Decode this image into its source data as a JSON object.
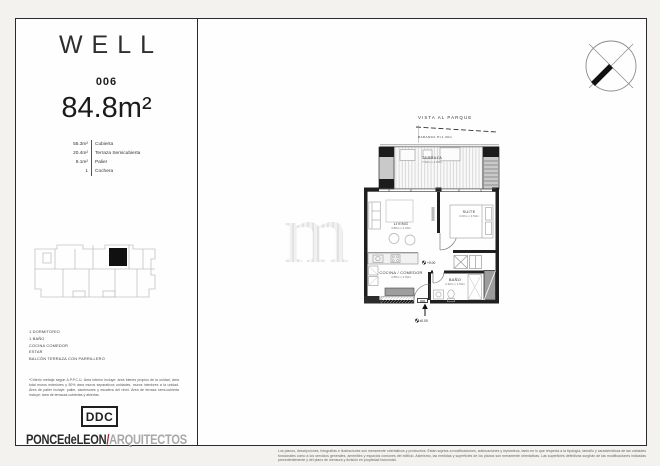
{
  "header": {
    "brand": "WELL",
    "unit": "006",
    "area": "84.8m²"
  },
  "areas": [
    {
      "value": "55.3m²",
      "label": "Cubierta"
    },
    {
      "value": "20.4m²",
      "label": "Terraza Semicubierta"
    },
    {
      "value": "9.1m²",
      "label": "Palier"
    },
    {
      "value": "1",
      "label": "Cochera"
    }
  ],
  "program": [
    "1 DORMITORIO",
    "1 BAÑO",
    "COCINA COMEDOR",
    "ESTAR",
    "BALCÓN TERRAZA CON PARRILLERO"
  ],
  "criteria_note": "*Criterio metraje según A.P.P.C.U. Área interior incluye: área bienes propios de la unidad, área total muros exteriores y 50% área muros separativos unidades, muros interiores a la unidad. Área de palier incluye: palier, ascensores y escalera del nivel. Área de terraza semi-cubierta incluye: área de terrazas cubiertas y abiertas.",
  "footer": {
    "ddc": "DDC",
    "studio_name": "PONCEdeLEON",
    "studio_divider": "/",
    "studio_role": "ARQUITECTOS"
  },
  "plan": {
    "vista_label": "VISTA AL PARQUE",
    "baranda_label": "BARANDA H=1.00m",
    "terraza": {
      "name": "TERRAZA",
      "dims": "7.50m x 2.50m"
    },
    "living": {
      "name": "LIVING",
      "dims": "4.85m x 4.00m"
    },
    "suite": {
      "name": "SUITE",
      "dims": "3.00m x 3.50m"
    },
    "cocina": {
      "name": "COCINA / COMEDOR",
      "dims": "3.85m x 2.50m"
    },
    "bano": {
      "name": "BAÑO",
      "dims": "2.30m x 1.50m"
    },
    "door_label": "006",
    "entry_level": "±0.00",
    "floor_level": "+0.00"
  },
  "legal_note": "Los planos, descripciones, fotografías e ilustraciones son meramente orientativos y provisorios. Están sujetos a modificaciones, adecuaciones y replanteos, tanto en lo que respecta a la tipología, tamaño y características de las unidades funcionales como a los servicios generales, amenities y espacios comunes del edificio. Asimismo, las medidas y superficies de los planos son meramente orientativas. Las superficies definitivas surgirán de las modificaciones indicadas precedentemente y del plano de mensura y división en propiedad horizontal.",
  "colors": {
    "accent_red": "#9d2f34",
    "muted_gray": "#a8a8a8",
    "ink": "#1f1f1f"
  }
}
